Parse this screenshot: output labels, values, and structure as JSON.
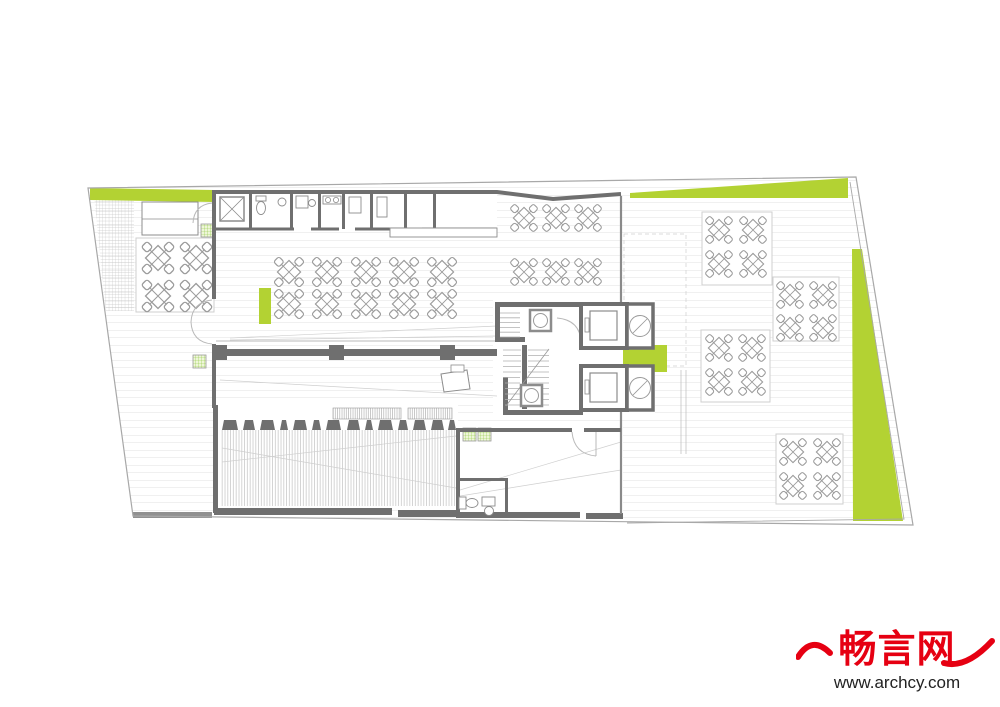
{
  "page": {
    "background": "#ffffff",
    "description": "architectural ground floor plan with dining tables, core, ramp and landscaped terrace"
  },
  "colors": {
    "accent_green": "#b3d233",
    "wall": "#6f6f6f",
    "brand_red": "#e60012",
    "url_dark": "#222222",
    "planter_green": "#8cc63f"
  },
  "watermark": {
    "brand": "畅言网",
    "url": "www.archcy.com"
  },
  "icons": {
    "table": "table-with-4-chairs-icon",
    "elevator": "elevator-car-icon",
    "stair": "staircase-icon",
    "toilet": "toilet-icon",
    "planter": "planter-grid-icon",
    "dumbwaiter": "circle-shaft-icon"
  },
  "plan": {
    "green_areas": [
      {
        "name": "north-strip",
        "points": "90,188 214,190 214,202 90,200"
      },
      {
        "name": "northeast-wedge",
        "points": "630,193 848,178 848,198 630,198"
      },
      {
        "name": "east-wedge",
        "points": "852,249 862,249 903,521 853,521"
      },
      {
        "name": "core-terrace-patch",
        "points": "623,345 667,345 667,372 623,372"
      },
      {
        "name": "dining-accent-bar",
        "points": "259,288 271,288 271,324 259,324"
      }
    ],
    "planters": [
      [
        201,
        224
      ],
      [
        193,
        355
      ],
      [
        463,
        428
      ],
      [
        478,
        428
      ]
    ],
    "tables": [
      {
        "x": 158,
        "y": 258,
        "s": 40
      },
      {
        "x": 196,
        "y": 258,
        "s": 40
      },
      {
        "x": 158,
        "y": 296,
        "s": 40
      },
      {
        "x": 196,
        "y": 296,
        "s": 40
      },
      {
        "x": 289,
        "y": 272,
        "s": 37
      },
      {
        "x": 327,
        "y": 272,
        "s": 37
      },
      {
        "x": 366,
        "y": 272,
        "s": 37
      },
      {
        "x": 404,
        "y": 272,
        "s": 37
      },
      {
        "x": 442,
        "y": 272,
        "s": 37
      },
      {
        "x": 289,
        "y": 304,
        "s": 37
      },
      {
        "x": 327,
        "y": 304,
        "s": 37
      },
      {
        "x": 366,
        "y": 304,
        "s": 37
      },
      {
        "x": 404,
        "y": 304,
        "s": 37
      },
      {
        "x": 442,
        "y": 304,
        "s": 37
      },
      {
        "x": 524,
        "y": 218,
        "s": 34
      },
      {
        "x": 556,
        "y": 218,
        "s": 34
      },
      {
        "x": 588,
        "y": 218,
        "s": 34
      },
      {
        "x": 524,
        "y": 272,
        "s": 34
      },
      {
        "x": 556,
        "y": 272,
        "s": 34
      },
      {
        "x": 588,
        "y": 272,
        "s": 34
      },
      {
        "x": 719,
        "y": 230,
        "s": 34
      },
      {
        "x": 753,
        "y": 230,
        "s": 34
      },
      {
        "x": 719,
        "y": 264,
        "s": 34
      },
      {
        "x": 753,
        "y": 264,
        "s": 34
      },
      {
        "x": 790,
        "y": 295,
        "s": 34
      },
      {
        "x": 823,
        "y": 295,
        "s": 34
      },
      {
        "x": 790,
        "y": 328,
        "s": 34
      },
      {
        "x": 823,
        "y": 328,
        "s": 34
      },
      {
        "x": 719,
        "y": 348,
        "s": 34
      },
      {
        "x": 752,
        "y": 348,
        "s": 34
      },
      {
        "x": 719,
        "y": 382,
        "s": 34
      },
      {
        "x": 752,
        "y": 382,
        "s": 34
      },
      {
        "x": 793,
        "y": 452,
        "s": 34
      },
      {
        "x": 827,
        "y": 452,
        "s": 34
      },
      {
        "x": 793,
        "y": 486,
        "s": 34
      },
      {
        "x": 827,
        "y": 486,
        "s": 34
      }
    ],
    "ramp_blocks": [
      [
        222,
        16
      ],
      [
        243,
        12
      ],
      [
        260,
        15
      ],
      [
        280,
        8
      ],
      [
        293,
        14
      ],
      [
        312,
        9
      ],
      [
        326,
        15
      ],
      [
        347,
        13
      ],
      [
        365,
        8
      ],
      [
        378,
        15
      ],
      [
        398,
        10
      ],
      [
        413,
        13
      ],
      [
        431,
        13
      ],
      [
        448,
        8
      ]
    ]
  }
}
